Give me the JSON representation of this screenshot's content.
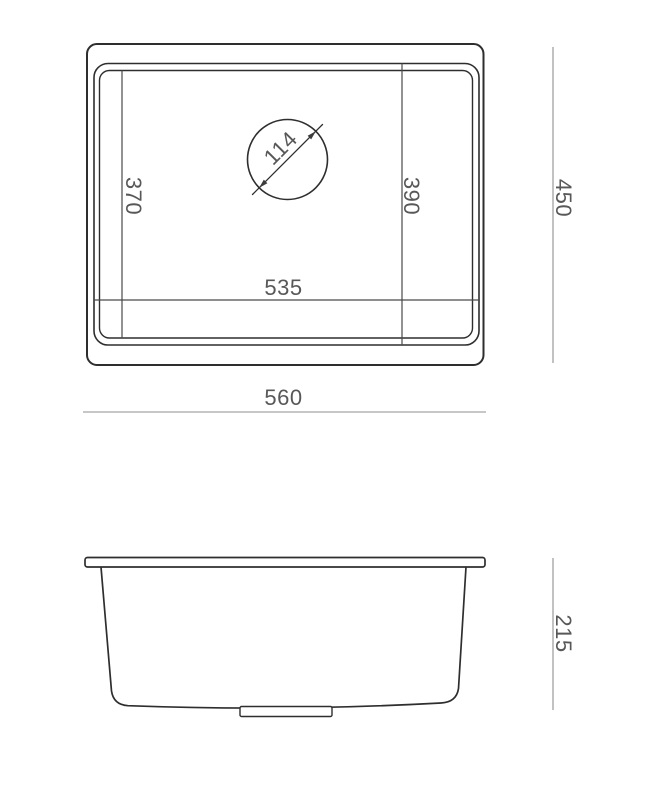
{
  "drawing": {
    "subject": "kitchen-sink-dimension-drawing",
    "views": {
      "top": "top-plan-view",
      "side": "front-elevation-view"
    },
    "colors": {
      "background": "#ffffff",
      "outline": "#2e2e2e",
      "dimension_line": "#8f8f8f",
      "label_text": "#58585a"
    },
    "top_view": {
      "labels": {
        "overall_width": "560",
        "overall_depth": "450",
        "bowl_width": "535",
        "bowl_depth_left": "370",
        "bowl_depth_right": "390",
        "drain_diameter": "114"
      }
    },
    "side_view": {
      "labels": {
        "bowl_height": "215"
      }
    }
  }
}
